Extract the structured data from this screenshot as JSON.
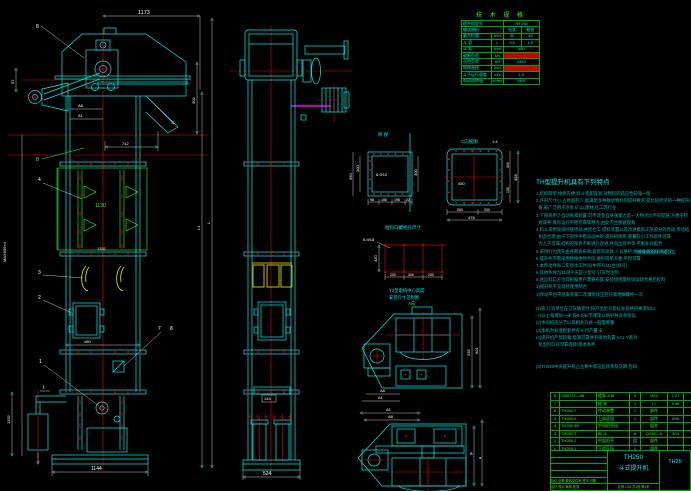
{
  "colors": {
    "bg": "#000000",
    "line_cyan": "#00eeee",
    "green": "#22ff22",
    "red": "#ee0000",
    "yellow": "#eeee00",
    "magenta": "#ff00ff",
    "dim_white": "#ffffff"
  },
  "front_view": {
    "dim_top": "1173",
    "dim_52": "52",
    "dim_a8": "A8",
    "dim_a1": "A1",
    "dim_302": "302",
    "dim_712": "712",
    "balloon_8": "8",
    "label_b": "B",
    "balloon_4": "4",
    "balloon_3": "3",
    "balloon_2": "2",
    "balloon_1": "1",
    "balloon_7": "7",
    "balloon_8b": "8",
    "section_mark": "I",
    "dim_1130": "1130",
    "label_mid": "1332",
    "dim_480": "480",
    "dim_1144": "1144",
    "dim_1332": "1332",
    "dim_max": "MAX600×4",
    "dim_l1": "L1",
    "dim_l": "L"
  },
  "side_view": {
    "dim_144": "144",
    "dim_524": "524"
  },
  "spec_table": {
    "title": "技 术 规 格",
    "r1_label": "提升机型号",
    "r1_value": "TH 250",
    "r2_label": "输送物料",
    "r2_v1": "粒状",
    "r2_v2": "粉状",
    "r3_label": "最大粒度",
    "r3_unit": "mm",
    "r3_v1": "30",
    "r3_v2": "48",
    "r4_label": "斗 容",
    "r4_unit": "L",
    "r4_v1": "3.0",
    "r4_v2": "1.5",
    "r5_label": "斗 距",
    "r5_unit": "mm",
    "r5_value": "450",
    "r6_label": "破断负荷",
    "r6_unit": "kN",
    "r7_label": "试验负荷",
    "r7_unit": "kN",
    "r7_value": "≥320",
    "r8_label": "规格直径",
    "r8_unit": "mm",
    "r9_label": "斗子运行速度",
    "r9_unit": "m/s",
    "r9_value": "1.5",
    "r10_label": "电动机转速",
    "r10_unit": "r/min",
    "r10_value": "48.5"
  },
  "section_left": {
    "label": "俯 视",
    "hole_note": "8-Φ12",
    "dim_left1": "300",
    "dim_left2": "350",
    "dim_right": "300",
    "b1": "98",
    "b2": "158",
    "b3": "198",
    "b4": "22"
  },
  "section_right": {
    "label": "C向视图",
    "scale": "1:4",
    "dim_inner": "450",
    "b1": "260",
    "b2": "200",
    "total_bottom": "478",
    "r1": "300",
    "r2": "150",
    "total_right": "458"
  },
  "feed_detail": {
    "title": "给料口螺栓孔尺寸",
    "hole_note": "8-Φ18",
    "dim_left": "420",
    "b1": "200",
    "b2": "300",
    "b3": "200"
  },
  "motor_note": {
    "line1": "Y2型电机中心高度",
    "line2": "安装尺寸见附图"
  },
  "detail_a": {
    "label": "A向",
    "dim_right1": "335",
    "dim_right2": "601",
    "dim_a8": "A8",
    "dim_a1": "A1"
  },
  "detail_b": {
    "dim_a1": "A1",
    "dim_a8": "A8",
    "dim_b": "B",
    "dim_a": "a"
  },
  "notes": {
    "title": "TH型提升机具有下列特点",
    "side_note": "特殊情况除外按订货",
    "lines": [
      "1.结构简单,维修方便,料斗装卸容易,对物料的适应性较强一般",
      "2.外形尺寸小,占地面积少,能满足多种散状物料的提升要求,是比较经济的一种提升设",
      "  备,被广泛用于冶金,矿山,建材,化工等行业",
      "3.下部采用了自动张紧装置,可不改变自身张紧力是一大特点比不同型链,方便于检",
      "  修保养,具有运行平稳可靠等特点,由此不生脱链现象",
      "4.料斗采用双排环链传动,并结合工.提料装置以及改进模具工序部分的传动,传动结",
      "  构造合理,由于下部件平稳运动中的,提升机体系,重量较小工作部件可靠",
      "  为之于可靠,结构的部件不断进行改进,并具出现中等,平衡补充配合",
      "5.采用行为预先由各期发布和,套装的装具,人员维护,维修处理的环境适宜",
      "6.提升机不需采用特殊维修手段 维护简单方便 平稳可靠",
      "7.本传动件每二年停水工时间(中带号)31台(样号)",
      "8.其他条件为31道今天是小型号,订货时注明",
      "9.进出料口方位可根据用户需要布置,安装使用需经试运转合格后投料",
      "1)提升机不宜斜装使用场合",
      "1)传动平台平面安装第二次灌浆找正后拧紧地脚螺栓一次",
      "",
      "(1)表.订货单位在订货确定时,按产品型号及标准规格的要求加以,",
      "  H以上每增加一米,按6.5米/节撑架以防护并多余架设.",
      "(2)中间机壳分节以及相关方式一般需要量",
      "(3)本机为标准配套件有 6 月产量 支",
      "(4)提升机严禁超载,电源可靠并有接地装置 ACL Y系列",
      "  及出料口有可靠连接/基本条件",
      "",
      "",
      "(5)TH250中央提升机占主要中等这些改革及货期 告知."
    ]
  },
  "bom": {
    "headers": [
      "序",
      "代 号",
      "名 称",
      "数量",
      "材 料",
      "重量",
      "备注"
    ],
    "rows": [
      [
        "8",
        "GB8727—88",
        "链条 20B",
        "4",
        "M22",
        "1.07",
        ""
      ],
      [
        "7",
        "",
        "链 条",
        "1",
        "L=",
        "9.06",
        ""
      ],
      [
        "6",
        "TH250.7",
        "传动装置",
        "1",
        "部件",
        "",
        ""
      ],
      [
        "5",
        "TH250.6",
        "上部区段",
        "1",
        "部件",
        "635",
        ""
      ],
      [
        "4",
        "TH250.4B",
        "中间机壳段",
        "",
        "组合",
        "",
        ""
      ],
      [
        "3",
        "TH250.3",
        "料 斗",
        "N",
        "Q235—A",
        "204",
        ""
      ],
      [
        "2",
        "TH250.2",
        "中部机壳",
        "组",
        "部件",
        "",
        ""
      ],
      [
        "1",
        "TH250.1",
        "下部区段",
        "1",
        "部件",
        "",
        ""
      ]
    ]
  },
  "title_block": {
    "model": "TH250",
    "product": "斗式提升机",
    "drawing_no": "TH25",
    "scale_row": "比例 1:25  共1张 第1张",
    "sign_row1": "标记 处数 更改文件号 签字 日期",
    "sign_row2": "设计 校对 审核 批准"
  }
}
